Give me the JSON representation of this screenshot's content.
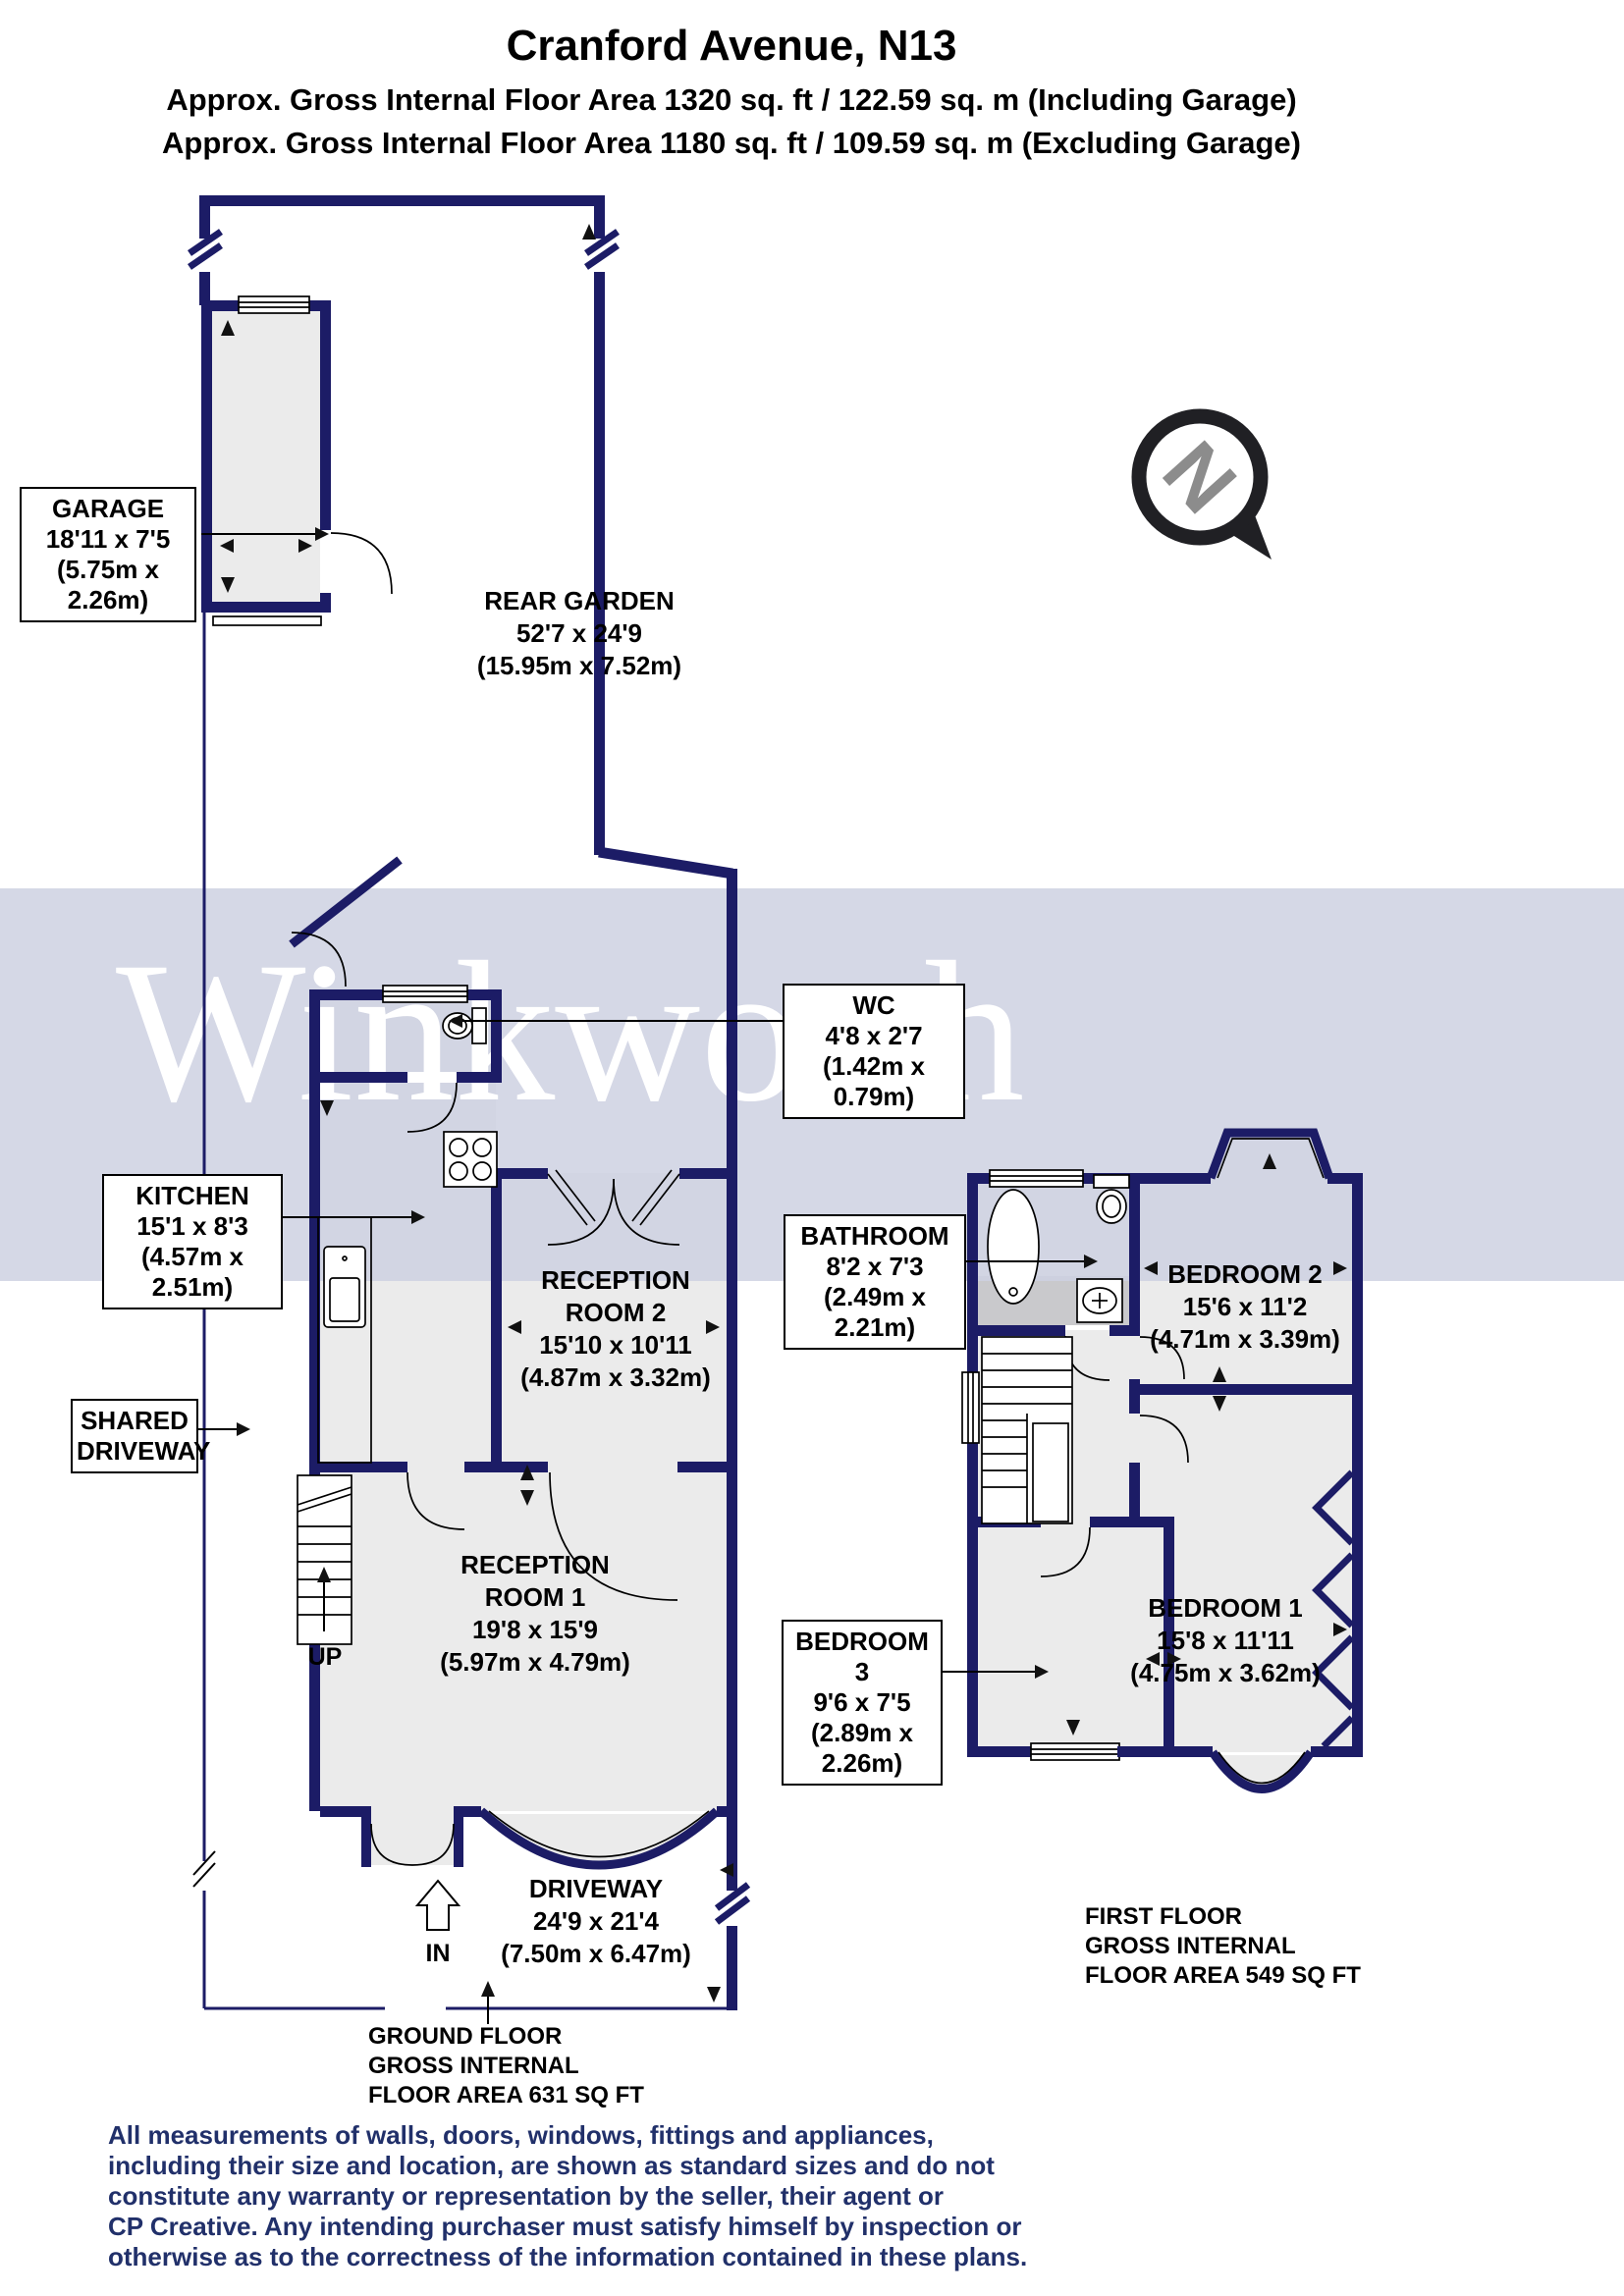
{
  "header": {
    "title": "Cranford Avenue, N13",
    "subtitle_including": "Approx. Gross Internal Floor Area 1320 sq. ft / 122.59 sq. m (Including Garage)",
    "subtitle_excluding": "Approx. Gross Internal Floor Area 1180 sq. ft / 109.59 sq. m (Excluding Garage)"
  },
  "watermark": "Winkworth",
  "compass": {
    "letter": "N"
  },
  "labels": {
    "garage": [
      "GARAGE",
      "18'11 x 7'5",
      "(5.75m x 2.26m)"
    ],
    "rear_garden": [
      "REAR GARDEN",
      "52'7 x 24'9",
      "(15.95m x 7.52m)"
    ],
    "wc": [
      "WC",
      "4'8 x 2'7",
      "(1.42m x 0.79m)"
    ],
    "kitchen": [
      "KITCHEN",
      "15'1 x 8'3",
      "(4.57m x 2.51m)"
    ],
    "reception_room_2": [
      "RECEPTION",
      "ROOM 2",
      "15'10 x 10'11",
      "(4.87m x 3.32m)"
    ],
    "reception_room_1": [
      "RECEPTION",
      "ROOM 1",
      "19'8 x 15'9",
      "(5.97m x 4.79m)"
    ],
    "shared_driveway": [
      "SHARED",
      "DRIVEWAY"
    ],
    "driveway": [
      "DRIVEWAY",
      "24'9 x 21'4",
      "(7.50m x 6.47m)"
    ],
    "bathroom": [
      "BATHROOM",
      "8'2 x 7'3",
      "(2.49m x 2.21m)"
    ],
    "bedroom_2": [
      "BEDROOM 2",
      "15'6 x 11'2",
      "(4.71m x 3.39m)"
    ],
    "bedroom_3": [
      "BEDROOM 3",
      "9'6 x 7'5",
      "(2.89m x 2.26m)"
    ],
    "bedroom_1": [
      "BEDROOM 1",
      "15'8 x 11'11",
      "(4.75m x 3.62m)"
    ],
    "up": "UP",
    "in": "IN"
  },
  "floor_areas": {
    "ground": [
      "GROUND FLOOR",
      "GROSS INTERNAL",
      "FLOOR AREA 631 SQ FT"
    ],
    "first": [
      "FIRST FLOOR",
      "GROSS INTERNAL",
      "FLOOR AREA 549 SQ FT"
    ]
  },
  "disclaimer": [
    "All measurements of walls, doors, windows, fittings and appliances,",
    "including their size and location, are shown as standard sizes and do not",
    "constitute any warranty or representation by the seller, their agent or",
    "CP Creative. Any intending purchaser must satisfy himself by inspection or",
    "otherwise as to the correctness of the information contained in these plans."
  ],
  "colors": {
    "wall": "#1c1c66",
    "watermark_band": "#ced1e2",
    "room_fill": "#ebebeb",
    "shaded_fill": "#c9c9cc",
    "disclaimer_text": "#21306a",
    "compass_letter": "#8c8c8c"
  }
}
